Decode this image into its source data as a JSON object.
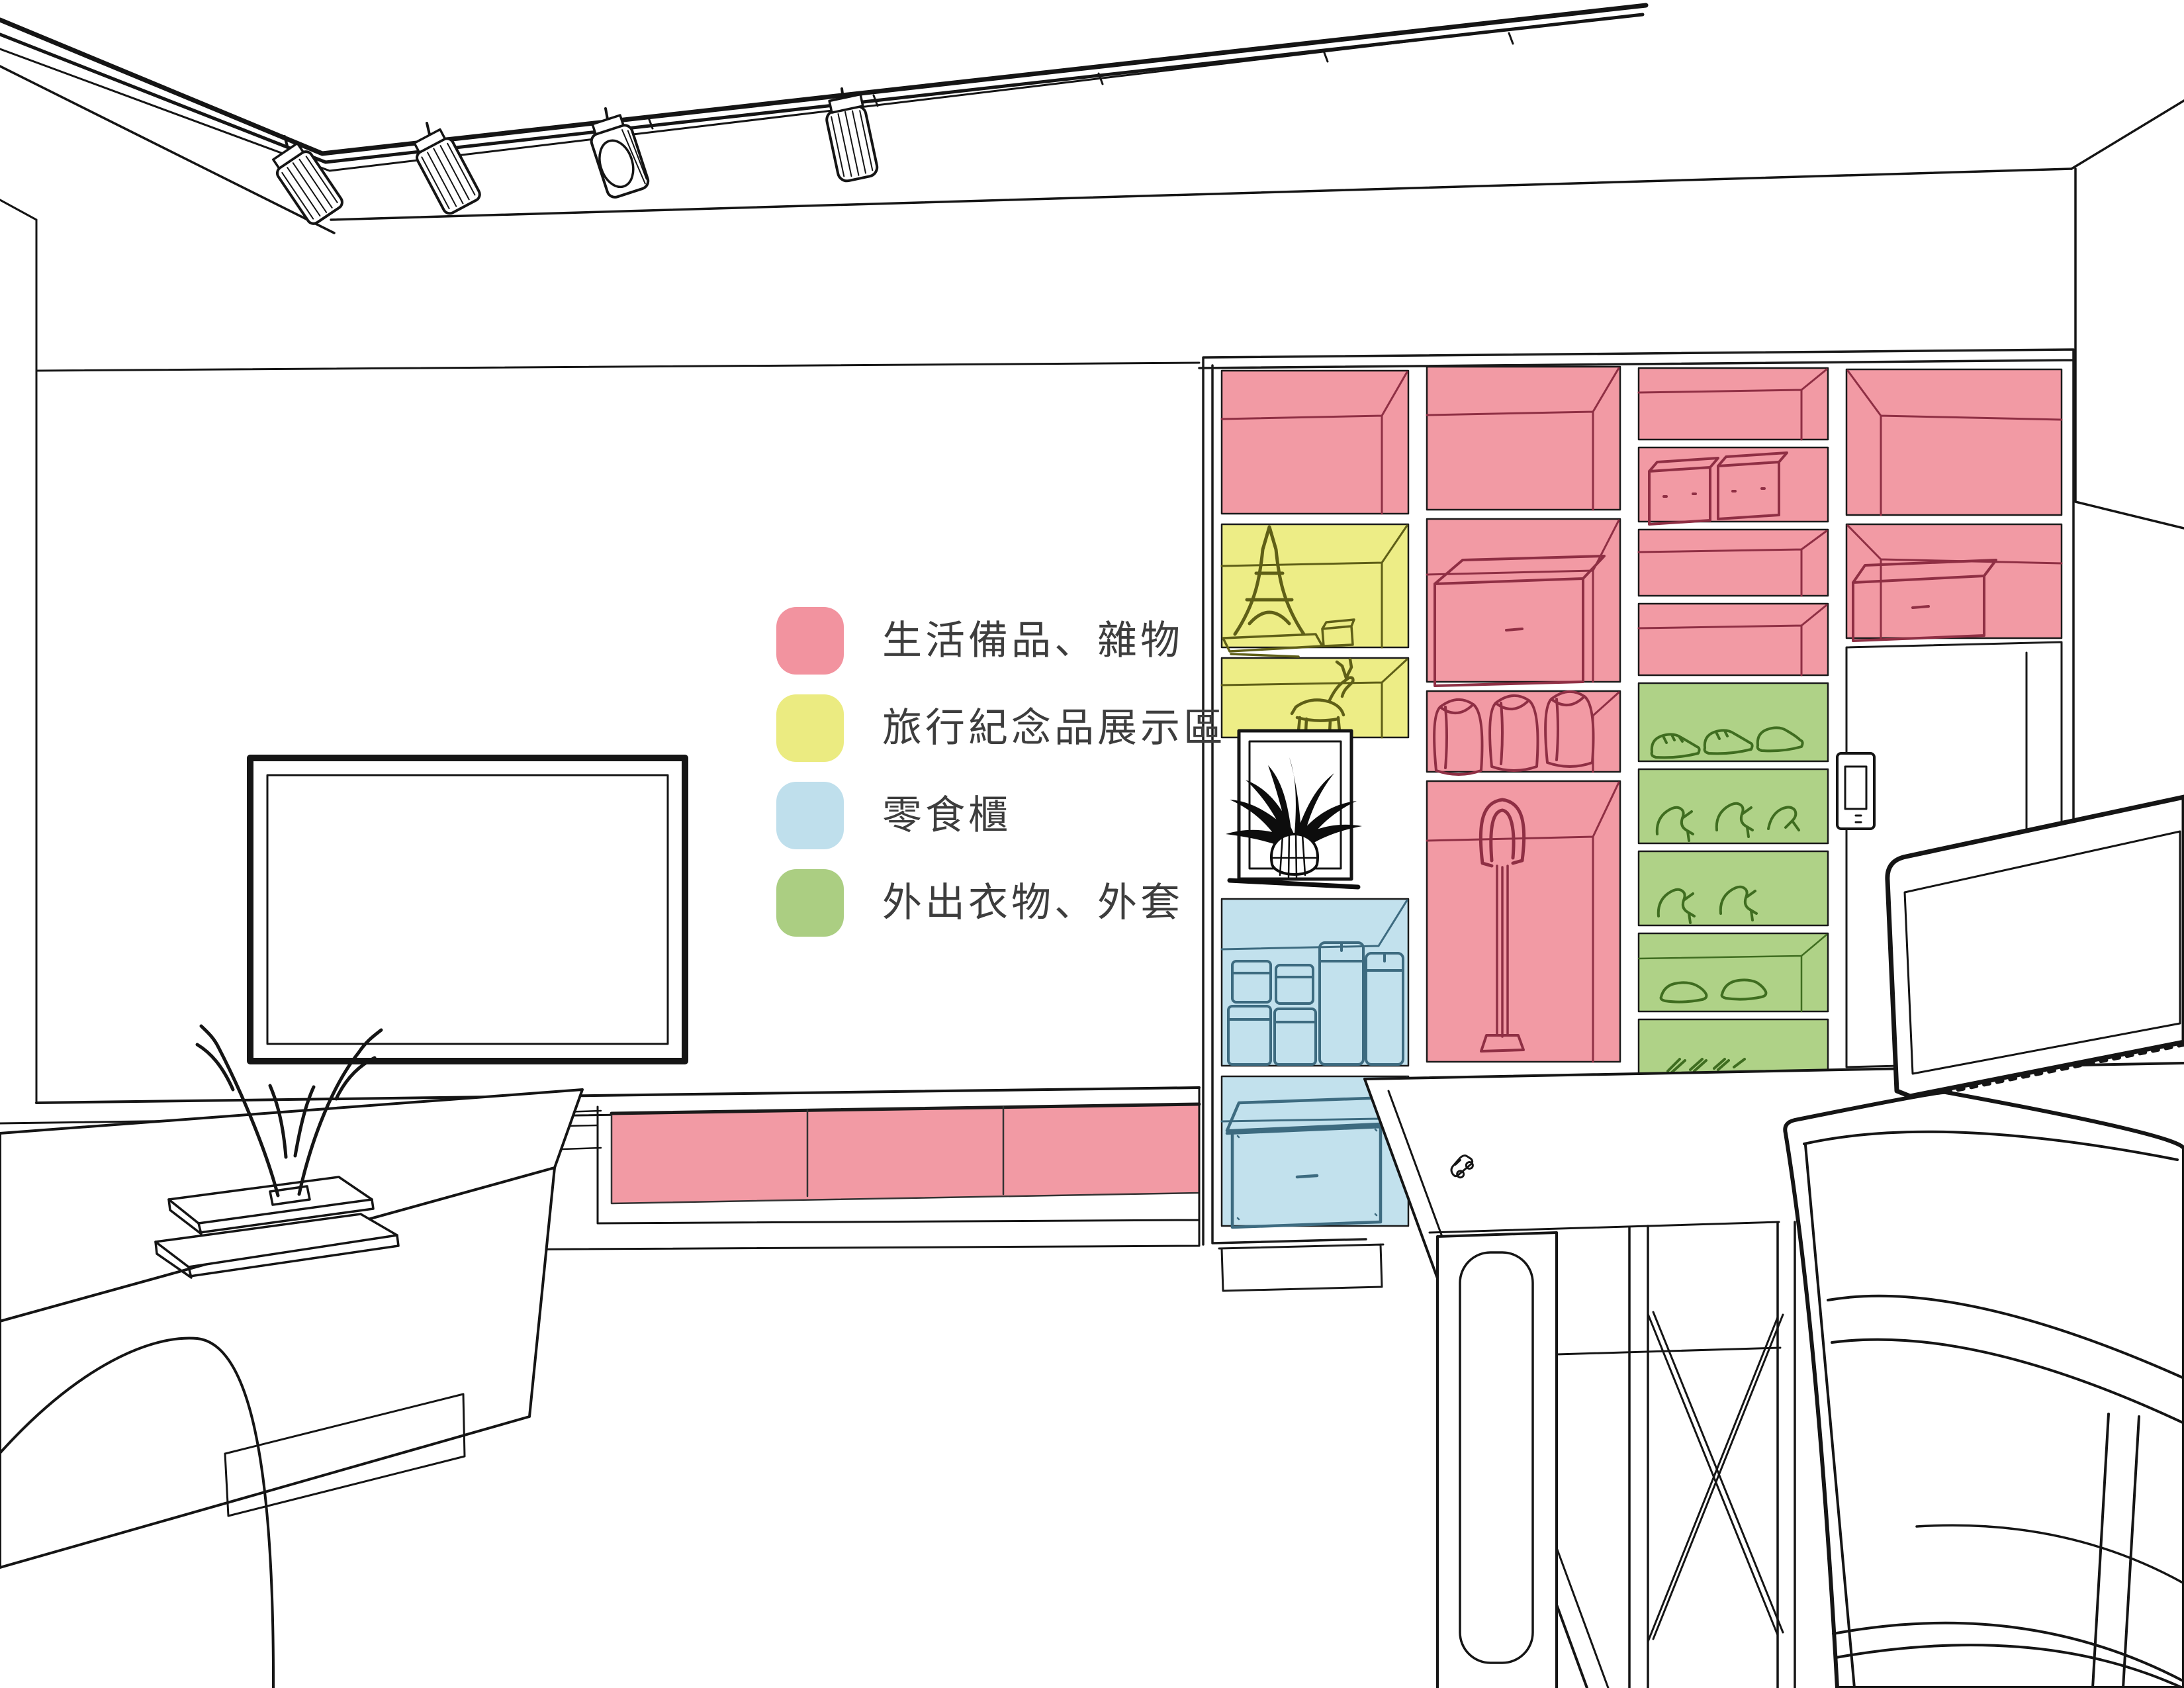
{
  "scene_type": "interior-zoning-rendering",
  "legend": {
    "items": [
      {
        "id": "daily-supplies",
        "label": "生活備品、雜物",
        "color": "#F2939F"
      },
      {
        "id": "travel-souvenirs",
        "label": "旅行紀念品展示區",
        "color": "#EBEB81"
      },
      {
        "id": "snack-cabinet",
        "label": "零食櫃",
        "color": "#BFDFEC"
      },
      {
        "id": "outdoor-clothes",
        "label": "外出衣物、外套",
        "color": "#ABCE82"
      }
    ]
  },
  "zones": {
    "pink": "#F29AA4",
    "yellow": "#EDED86",
    "blue": "#C2E1ED",
    "green": "#AFD287"
  },
  "inks": {
    "line": "#151515",
    "pink": "#8F2F44",
    "yellow": "#5F5F17",
    "blue": "#3D6B80",
    "green": "#3F6D20"
  }
}
